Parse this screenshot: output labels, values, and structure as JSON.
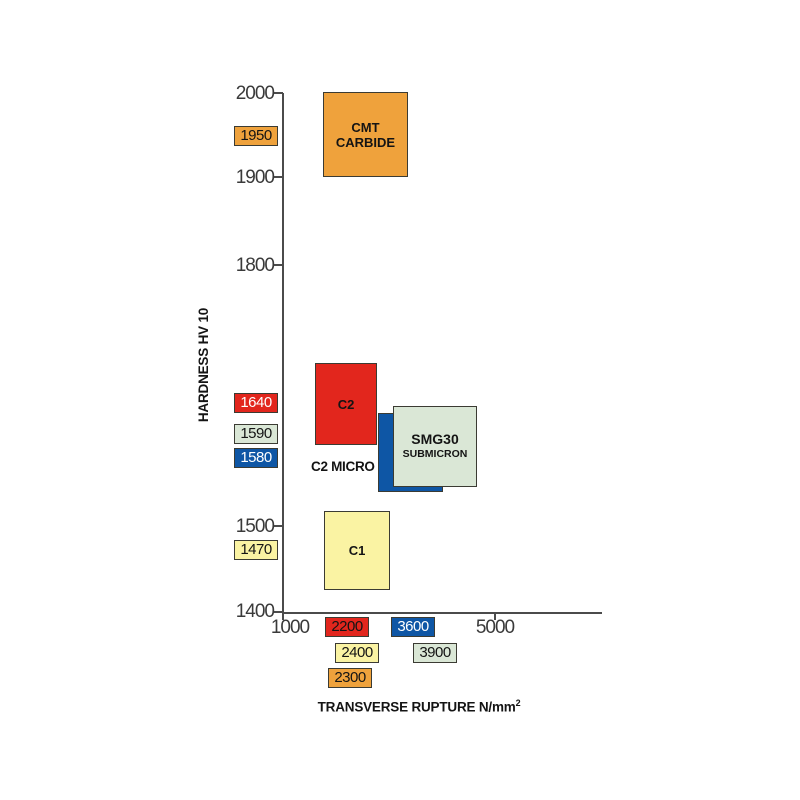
{
  "chart_data": {
    "type": "scatter",
    "note": "each series is a rectangular region (x_range by y_range) of hardness vs transverse rupture strength; labeled point values shown as colored badges on both axes",
    "title": "",
    "xlabel": "TRANSVERSE RUPTURE N/mm2",
    "ylabel": "HARDNESS HV 10",
    "xlim": [
      1000,
      7000
    ],
    "ylim": [
      1400,
      2000
    ],
    "xticks": [
      1000,
      5000
    ],
    "yticks": [
      2000,
      1900,
      1800,
      1500,
      1400
    ],
    "grid": false,
    "legend": "none",
    "series": [
      {
        "name": "CMT CARBIDE",
        "label_lines": [
          "CMT",
          "CARBIDE"
        ],
        "color": "#EFA23C",
        "hardness_hv10": 1950,
        "transverse_rupture": 2300,
        "x_range": [
          1750,
          3350
        ],
        "y_range": [
          1905,
          2000
        ]
      },
      {
        "name": "C2",
        "label_lines": [
          "C2"
        ],
        "color": "#E2261D",
        "hardness_hv10": 1640,
        "transverse_rupture": 2200,
        "x_range": [
          1600,
          2770
        ],
        "y_range": [
          1595,
          1690
        ]
      },
      {
        "name": "C2 MICRO",
        "label_lines": [
          "C2 MICRO"
        ],
        "color": "#0E56A5",
        "hardness_hv10": 1580,
        "transverse_rupture": 3600,
        "x_range": [
          2790,
          4020
        ],
        "y_range": [
          1540,
          1630
        ]
      },
      {
        "name": "SMG30 SUBMICRON",
        "label_lines": [
          "SMG30",
          "SUBMICRON"
        ],
        "color": "#DAE7D6",
        "hardness_hv10": 1590,
        "transverse_rupture": 3900,
        "x_range": [
          3080,
          4660
        ],
        "y_range": [
          1545,
          1640
        ]
      },
      {
        "name": "C1",
        "label_lines": [
          "C1"
        ],
        "color": "#FAF3A3",
        "hardness_hv10": 1470,
        "transverse_rupture": 2400,
        "x_range": [
          1775,
          3020
        ],
        "y_range": [
          1425,
          1520
        ]
      }
    ]
  },
  "axes": {
    "y_title": "HARDNESS HV 10",
    "x_title": "TRANSVERSE RUPTURE N/mm",
    "x_title_sup": "2",
    "y_ticks": [
      "2000",
      "1900",
      "1800",
      "1500",
      "1400"
    ],
    "x_ticks": [
      "1000",
      "5000"
    ]
  },
  "hardness_labels": [
    {
      "value": "1950",
      "bg": "#EFA23C",
      "fg": "#141414"
    },
    {
      "value": "1640",
      "bg": "#E2261D",
      "fg": "#FFFFFF"
    },
    {
      "value": "1590",
      "bg": "#DAE7D6",
      "fg": "#141414"
    },
    {
      "value": "1580",
      "bg": "#0E56A5",
      "fg": "#FFFFFF"
    },
    {
      "value": "1470",
      "bg": "#FAF3A3",
      "fg": "#141414"
    }
  ],
  "rupture_labels": [
    {
      "value": "2200",
      "bg": "#E2261D",
      "fg": "#141414"
    },
    {
      "value": "3600",
      "bg": "#0E56A5",
      "fg": "#FFFFFF"
    },
    {
      "value": "2400",
      "bg": "#FAF3A3",
      "fg": "#141414"
    },
    {
      "value": "3900",
      "bg": "#DAE7D6",
      "fg": "#141414"
    },
    {
      "value": "2300",
      "bg": "#EFA23C",
      "fg": "#141414"
    }
  ]
}
